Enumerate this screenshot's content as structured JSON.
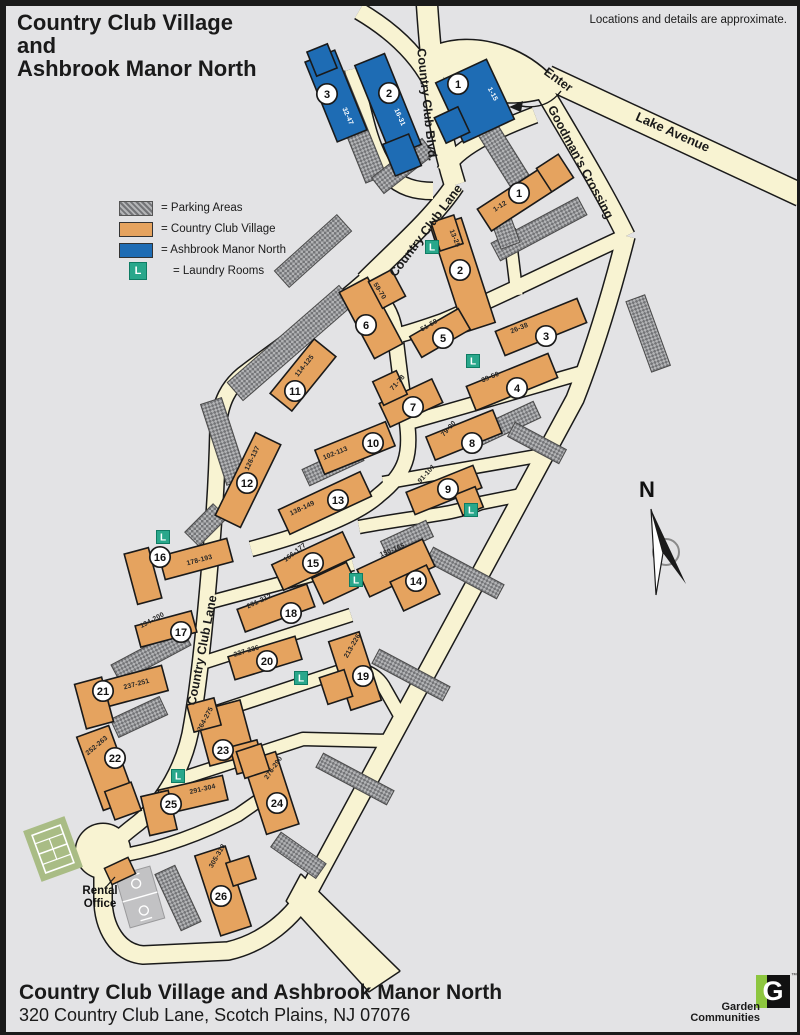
{
  "header": {
    "title_lines": [
      "Country Club Village",
      "and",
      "Ashbrook Manor North"
    ],
    "disclaimer": "Locations and details are approximate."
  },
  "colors": {
    "village": "#e5a35f",
    "manor": "#1e6cb4",
    "laundry": "#29a78b",
    "road": "#f8f3d2",
    "background": "#e3e3e5",
    "tennis": "#a9bc85",
    "court": "#c2c2c4"
  },
  "legend": {
    "items": [
      {
        "key": "parking",
        "label": "= Parking Areas"
      },
      {
        "key": "village",
        "label": "= Country Club Village"
      },
      {
        "key": "manor",
        "label": "= Ashbrook Manor North"
      },
      {
        "key": "laundry",
        "label": "= Laundry Rooms",
        "letter": "L"
      }
    ]
  },
  "map": {
    "north_label": "N",
    "laundry_letter": "L",
    "rental_office": {
      "lines": [
        "Rental",
        "Office"
      ]
    },
    "road_labels": [
      {
        "text": "Country Club Blvd.",
        "x": 420,
        "y": 102,
        "rot": 84,
        "size": 12.5
      },
      {
        "text": "Country Club Lane",
        "x": 426,
        "y": 230,
        "rot": -53,
        "size": 12.5
      },
      {
        "text": "Country Club Lane",
        "x": 203,
        "y": 648,
        "rot": -79,
        "size": 12.5
      },
      {
        "text": "Lake Avenue",
        "x": 668,
        "y": 133,
        "rot": 24,
        "size": 13
      },
      {
        "text": "Goodman's Crossing",
        "x": 574,
        "y": 161,
        "rot": 62,
        "size": 12.5
      },
      {
        "text": "Enter",
        "x": 553,
        "y": 80,
        "rot": 36,
        "size": 12.5
      }
    ],
    "buildings": [
      {
        "num": "1",
        "range": "1-15",
        "type": "manor",
        "rects": [
          [
            472,
            98,
            56,
            66,
            -25
          ],
          [
            449,
            122,
            26,
            28,
            -25
          ]
        ],
        "label": [
          488,
          92,
          62
        ],
        "circle": [
          455,
          81
        ]
      },
      {
        "num": "2",
        "range": "16-31",
        "type": "manor",
        "rects": [
          [
            385,
            102,
            32,
            98,
            -22
          ],
          [
            399,
            152,
            28,
            34,
            -22
          ]
        ],
        "label": [
          395,
          115,
          66
        ],
        "circle": [
          386,
          90
        ]
      },
      {
        "num": "3",
        "range": "32-47",
        "type": "manor",
        "rects": [
          [
            333,
            93,
            32,
            86,
            -22
          ],
          [
            319,
            57,
            22,
            26,
            -22
          ]
        ],
        "label": [
          343,
          114,
          66
        ],
        "circle": [
          324,
          91
        ]
      },
      {
        "num": "1",
        "range": "1-12",
        "type": "village",
        "rects": [
          [
            520,
            192,
            92,
            26,
            -33
          ],
          [
            552,
            170,
            26,
            28,
            -33
          ]
        ],
        "label": [
          498,
          205,
          -33
        ],
        "circle": [
          516,
          190
        ]
      },
      {
        "num": "2",
        "range": "13-25",
        "type": "village",
        "rects": [
          [
            460,
            272,
            32,
            110,
            -18
          ],
          [
            444,
            230,
            24,
            30,
            -18
          ]
        ],
        "label": [
          450,
          236,
          68
        ],
        "circle": [
          457,
          267
        ]
      },
      {
        "num": "3",
        "range": "26-38",
        "type": "village",
        "rects": [
          [
            538,
            324,
            88,
            26,
            -22
          ]
        ],
        "label": [
          517,
          327,
          -22
        ],
        "circle": [
          543,
          333
        ]
      },
      {
        "num": "4",
        "range": "39-50",
        "type": "village",
        "rects": [
          [
            509,
            379,
            88,
            26,
            -22
          ]
        ],
        "label": [
          488,
          376,
          -22
        ],
        "circle": [
          514,
          385
        ]
      },
      {
        "num": "5",
        "range": "51-58",
        "type": "village",
        "rects": [
          [
            437,
            330,
            56,
            24,
            -30
          ]
        ],
        "label": [
          427,
          324,
          -30
        ],
        "circle": [
          440,
          335
        ]
      },
      {
        "num": "6",
        "range": "59-70",
        "type": "village",
        "rects": [
          [
            368,
            315,
            32,
            75,
            -28
          ],
          [
            384,
            286,
            26,
            30,
            -28
          ]
        ],
        "label": [
          375,
          289,
          58
        ],
        "circle": [
          363,
          322
        ]
      },
      {
        "num": "7",
        "range": "71-78",
        "type": "village",
        "rects": [
          [
            408,
            400,
            58,
            26,
            -25
          ],
          [
            387,
            385,
            26,
            26,
            -25
          ]
        ],
        "label": [
          396,
          381,
          -48
        ],
        "circle": [
          410,
          404
        ]
      },
      {
        "num": "8",
        "range": "79-90",
        "type": "village",
        "rects": [
          [
            461,
            432,
            72,
            25,
            -22
          ]
        ],
        "label": [
          447,
          427,
          -48
        ],
        "circle": [
          469,
          440
        ]
      },
      {
        "num": "9",
        "range": "91-101",
        "type": "village",
        "rects": [
          [
            441,
            487,
            72,
            24,
            -22
          ],
          [
            466,
            498,
            22,
            22,
            -22
          ]
        ],
        "label": [
          425,
          472,
          -48
        ],
        "circle": [
          445,
          486
        ]
      },
      {
        "num": "10",
        "range": "102-113",
        "type": "village",
        "rects": [
          [
            352,
            445,
            76,
            26,
            -22
          ]
        ],
        "label": [
          333,
          452,
          -22
        ],
        "circle": [
          370,
          440
        ]
      },
      {
        "num": "11",
        "range": "114-125",
        "type": "village",
        "rects": [
          [
            300,
            372,
            70,
            28,
            -51
          ]
        ],
        "label": [
          303,
          364,
          -51
        ],
        "circle": [
          292,
          388
        ]
      },
      {
        "num": "12",
        "range": "126-137",
        "type": "village",
        "rects": [
          [
            245,
            477,
            92,
            28,
            -64
          ]
        ],
        "label": [
          251,
          456,
          -64
        ],
        "circle": [
          244,
          480
        ]
      },
      {
        "num": "13",
        "range": "138-149",
        "type": "village",
        "rects": [
          [
            322,
            500,
            90,
            27,
            -25
          ]
        ],
        "label": [
          300,
          507,
          -25
        ],
        "circle": [
          335,
          497
        ]
      },
      {
        "num": "14",
        "range": "150-165",
        "type": "village",
        "rects": [
          [
            393,
            565,
            72,
            30,
            -25
          ],
          [
            412,
            585,
            40,
            32,
            -25
          ]
        ],
        "label": [
          390,
          549,
          -22
        ],
        "circle": [
          413,
          578
        ]
      },
      {
        "num": "15",
        "range": "166-177",
        "type": "village",
        "rects": [
          [
            310,
            558,
            78,
            28,
            -25
          ],
          [
            332,
            580,
            38,
            28,
            -25
          ]
        ],
        "label": [
          293,
          551,
          -38
        ],
        "circle": [
          310,
          560
        ]
      },
      {
        "num": "16",
        "range": "178-193",
        "type": "village",
        "rects": [
          [
            193,
            556,
            70,
            24,
            -15
          ],
          [
            140,
            573,
            25,
            52,
            -15
          ]
        ],
        "label": [
          197,
          559,
          -15
        ],
        "circle": [
          157,
          554
        ]
      },
      {
        "num": "17",
        "range": "194-200",
        "type": "village",
        "rects": [
          [
            163,
            626,
            58,
            22,
            -15
          ]
        ],
        "label": [
          150,
          619,
          -28
        ],
        "circle": [
          178,
          629
        ]
      },
      {
        "num": "18",
        "range": "201-212",
        "type": "village",
        "rects": [
          [
            273,
            605,
            74,
            24,
            -20
          ]
        ],
        "label": [
          257,
          600,
          -25
        ],
        "circle": [
          288,
          610
        ]
      },
      {
        "num": "19",
        "range": "213-226",
        "type": "village",
        "rects": [
          [
            352,
            668,
            32,
            72,
            -18
          ],
          [
            333,
            684,
            26,
            28,
            -18
          ]
        ],
        "label": [
          351,
          644,
          -60
        ],
        "circle": [
          360,
          673
        ]
      },
      {
        "num": "20",
        "range": "227-236",
        "type": "village",
        "rects": [
          [
            262,
            655,
            70,
            24,
            -17
          ]
        ],
        "label": [
          244,
          650,
          -17
        ],
        "circle": [
          264,
          658
        ]
      },
      {
        "num": "21",
        "range": "237-251",
        "type": "village",
        "rects": [
          [
            128,
            684,
            70,
            26,
            -15
          ],
          [
            91,
            700,
            28,
            46,
            -15
          ]
        ],
        "label": [
          134,
          683,
          -15
        ],
        "circle": [
          100,
          688
        ]
      },
      {
        "num": "22",
        "range": "252-263",
        "type": "village",
        "rects": [
          [
            103,
            765,
            34,
            78,
            -20
          ],
          [
            120,
            798,
            28,
            30,
            -20
          ]
        ],
        "label": [
          95,
          744,
          -40
        ],
        "circle": [
          112,
          755
        ]
      },
      {
        "num": "23",
        "range": "264-275",
        "type": "village",
        "rects": [
          [
            222,
            730,
            46,
            56,
            -15
          ],
          [
            201,
            712,
            28,
            28,
            -15
          ],
          [
            244,
            754,
            28,
            28,
            -15
          ]
        ],
        "label": [
          204,
          717,
          -62
        ],
        "circle": [
          220,
          747
        ]
      },
      {
        "num": "24",
        "range": "276-290",
        "type": "village",
        "rects": [
          [
            268,
            790,
            34,
            76,
            -18
          ],
          [
            250,
            758,
            26,
            28,
            -18
          ]
        ],
        "label": [
          272,
          766,
          -55
        ],
        "circle": [
          274,
          800
        ]
      },
      {
        "num": "25",
        "range": "291-304",
        "type": "village",
        "rects": [
          [
            190,
            792,
            66,
            25,
            -13
          ],
          [
            156,
            810,
            28,
            40,
            -13
          ]
        ],
        "label": [
          200,
          788,
          -13
        ],
        "circle": [
          168,
          801
        ]
      },
      {
        "num": "26",
        "range": "305-318",
        "type": "village",
        "rects": [
          [
            220,
            888,
            32,
            84,
            -18
          ],
          [
            238,
            868,
            24,
            24,
            -18
          ]
        ],
        "label": [
          216,
          854,
          -60
        ],
        "circle": [
          218,
          893
        ]
      }
    ],
    "laundry": [
      [
        429,
        244
      ],
      [
        470,
        358
      ],
      [
        468,
        507
      ],
      [
        353,
        577
      ],
      [
        160,
        534
      ],
      [
        298,
        675
      ],
      [
        175,
        773
      ]
    ]
  },
  "footer": {
    "title": "Country Club Village and Ashbrook Manor North",
    "address": "320 Country Club Lane, Scotch Plains, NJ 07076"
  },
  "logo": {
    "letter": "G",
    "tm": "™",
    "line1": "Garden",
    "line2": "Communities",
    "green": "#8dc63f"
  }
}
